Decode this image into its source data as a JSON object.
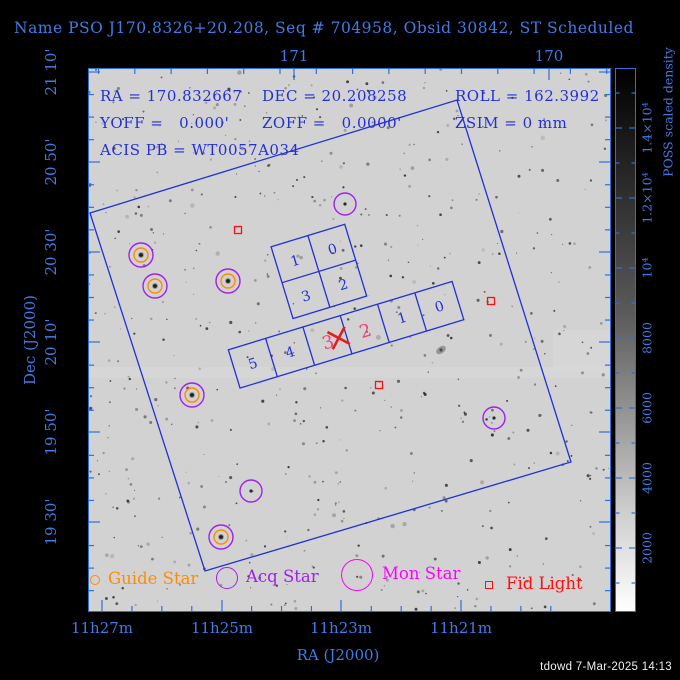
{
  "title": "Name PSO J170.8326+20.208, Seq # 704958, Obsid 30842, ST Scheduled",
  "info": {
    "ra": "RA = 170.832667",
    "dec": "DEC = 20.208258",
    "roll": "ROLL = 162.3992",
    "yoff": "YOFF =   0.000'",
    "zoff": "ZOFF =   0.0000'",
    "zsim": "ZSIM = 0 mm",
    "acis_pb": "ACIS PB = WT0057A034"
  },
  "footer": "tdowd  7-Mar-2025 14:13",
  "axes": {
    "bottom_title": "RA (J2000)",
    "left_title": "Dec (J2000)",
    "top_ticks": [
      {
        "label": "171",
        "x": 294
      },
      {
        "label": "170",
        "x": 549
      }
    ],
    "bottom_ticks": [
      {
        "label": "11h27m",
        "x": 102
      },
      {
        "label": "11h25m",
        "x": 222
      },
      {
        "label": "11h23m",
        "x": 341
      },
      {
        "label": "11h21m",
        "x": 461
      }
    ],
    "left_ticks": [
      {
        "label": "21 10'",
        "y": 72
      },
      {
        "label": "20 50'",
        "y": 162
      },
      {
        "label": "20 30'",
        "y": 252
      },
      {
        "label": "20 10'",
        "y": 342
      },
      {
        "label": "19 50'",
        "y": 432
      },
      {
        "label": "19 30'",
        "y": 522
      }
    ]
  },
  "colorbar": {
    "title": "POSS scaled density",
    "tick_labels": [
      {
        "label": "2000",
        "y": 548
      },
      {
        "label": "4000",
        "y": 478
      },
      {
        "label": "6000",
        "y": 408
      },
      {
        "label": "8000",
        "y": 338
      },
      {
        "label": "10⁴",
        "y": 268
      },
      {
        "label": "1.2×10⁴",
        "y": 198
      },
      {
        "label": "1.4×10⁴",
        "y": 128
      }
    ]
  },
  "legend": [
    {
      "label": "Guide Star",
      "shape": "circle",
      "color": "#ff8c00",
      "r": 5,
      "cx": 95,
      "cy": 580,
      "tx": 108
    },
    {
      "label": "Acq Star",
      "shape": "circle",
      "color": "#a020f0",
      "r": 11,
      "cx": 227,
      "cy": 578,
      "tx": 246
    },
    {
      "label": "Mon Star",
      "shape": "circle",
      "color": "#ff00ff",
      "r": 16,
      "cx": 357,
      "cy": 575,
      "tx": 382
    },
    {
      "label": "Fid Light",
      "shape": "square",
      "color": "#ff1010",
      "r": 4,
      "cx": 489,
      "cy": 585,
      "tx": 506
    }
  ],
  "chart_data": {
    "type": "scatter",
    "title": "Chandra observation pointing chart over POSS sky image",
    "pointing": {
      "ra_deg": 170.832667,
      "dec_deg": 20.208258,
      "roll_deg": 162.3992,
      "yoff_arcmin": 0.0,
      "zoff_arcmin": 0.0,
      "zsim_mm": 0,
      "acis_parameter_block": "WT0057A034"
    },
    "x_axis": {
      "label": "RA (J2000)",
      "tick_labels": [
        "11h27m",
        "11h25m",
        "11h23m",
        "11h21m"
      ],
      "top_tick_labels_deg": [
        "171",
        "170"
      ],
      "direction": "RA increases leftward"
    },
    "y_axis": {
      "label": "Dec (J2000)",
      "tick_labels": [
        "21 10'",
        "20 50'",
        "20 30'",
        "20 10'",
        "19 50'",
        "19 30'"
      ]
    },
    "colorbar": {
      "label": "POSS scaled density",
      "tick_labels": [
        "2000",
        "4000",
        "6000",
        "8000",
        "10⁴",
        "1.2×10⁴",
        "1.4×10⁴"
      ],
      "range_top_to_bottom": "dark high to light low"
    },
    "fov_polygon_px": [
      [
        90,
        213
      ],
      [
        457,
        100
      ],
      [
        571,
        462
      ],
      [
        205,
        571
      ]
    ],
    "acis": {
      "rotation_deg": -17,
      "aimpoint_px": [
        339,
        338
      ],
      "i_chip_labels": [
        "1",
        "0",
        "3",
        "2"
      ],
      "s_chip_labels": [
        "5",
        "4",
        "3",
        "2",
        "1",
        "0"
      ],
      "s_pink_labels": [
        "3",
        "2"
      ]
    },
    "markers": {
      "guide_acq_star_pairs_px": [
        [
          141,
          255
        ],
        [
          155,
          286
        ],
        [
          228,
          281
        ],
        [
          192,
          395
        ],
        [
          221,
          537
        ]
      ],
      "acq_star_only_px": [
        [
          345,
          204
        ],
        [
          494,
          418
        ],
        [
          251,
          491
        ]
      ],
      "fid_lights_px": [
        [
          238,
          230
        ],
        [
          491,
          301
        ],
        [
          379,
          385
        ]
      ]
    }
  },
  "colors": {
    "background": "#000000",
    "frame_blue": "#2e6fd8",
    "label_blue": "#3e7ce8",
    "overlay_blue": "#2230d8",
    "sky_gray": "#d2d2d2",
    "guide_orange": "#ff8c00",
    "acq_purple": "#a020f0",
    "mon_magenta": "#ff00ff",
    "fid_red": "#ff1010",
    "aim_red": "#e02020",
    "pink_chip": "#f0407f",
    "footer_white": "#efefef"
  }
}
